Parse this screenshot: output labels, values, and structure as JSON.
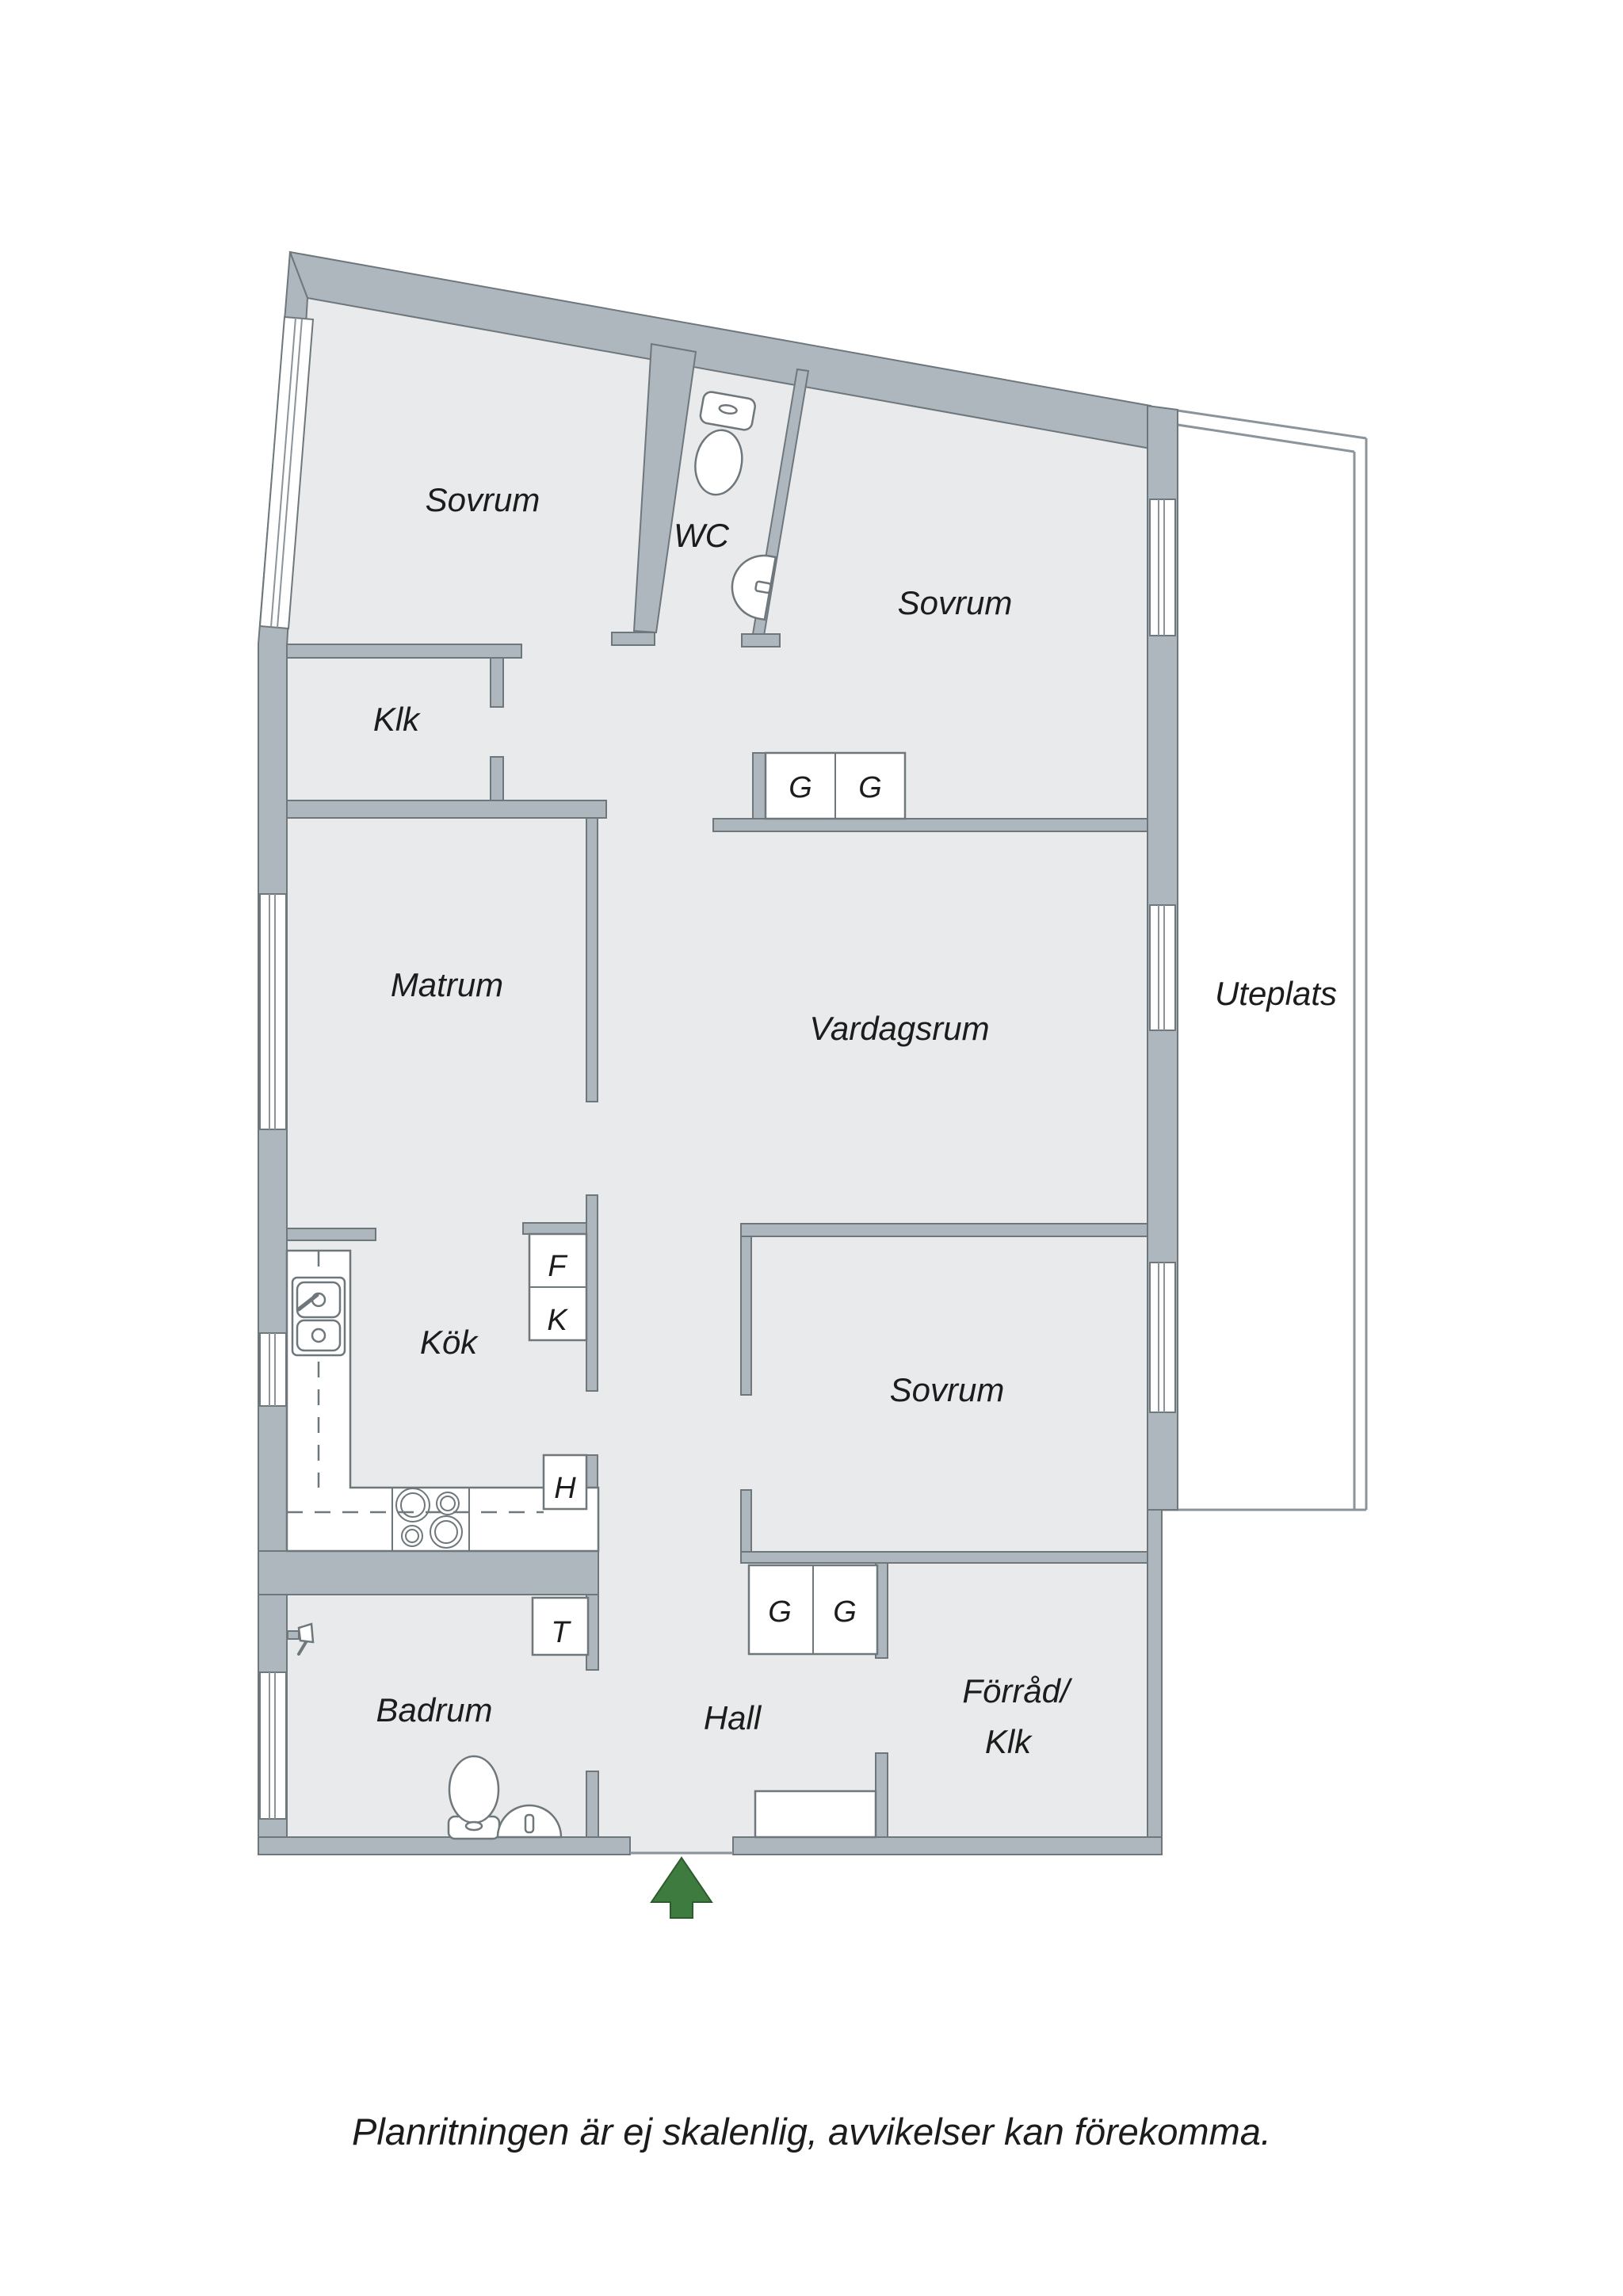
{
  "plan": {
    "caption": "Planritningen är ej skalenlig, avvikelser kan förekomma.",
    "colors": {
      "wall": "#aeb7bd",
      "floor": "#e9eaeb",
      "outline": "#6e777c",
      "window_line": "#8b949a",
      "entry_arrow_green": "#3e7b3f",
      "text": "#1b1c1c"
    },
    "rooms": {
      "bedroom_top_left": "Sovrum",
      "wc": "WC",
      "bedroom_top_right": "Sovrum",
      "closet_top": "Klk",
      "dining_room": "Matrum",
      "living_room": "Vardagsrum",
      "patio": "Uteplats",
      "kitchen": "Kök",
      "bedroom_right": "Sovrum",
      "bathroom": "Badrum",
      "hall": "Hall",
      "storage_line1": "Förråd/",
      "storage_line2": "Klk"
    },
    "units": {
      "wardrobe": "G",
      "freezer": "F",
      "fridge": "K",
      "tall_cabinet": "H",
      "dryer": "T"
    }
  }
}
